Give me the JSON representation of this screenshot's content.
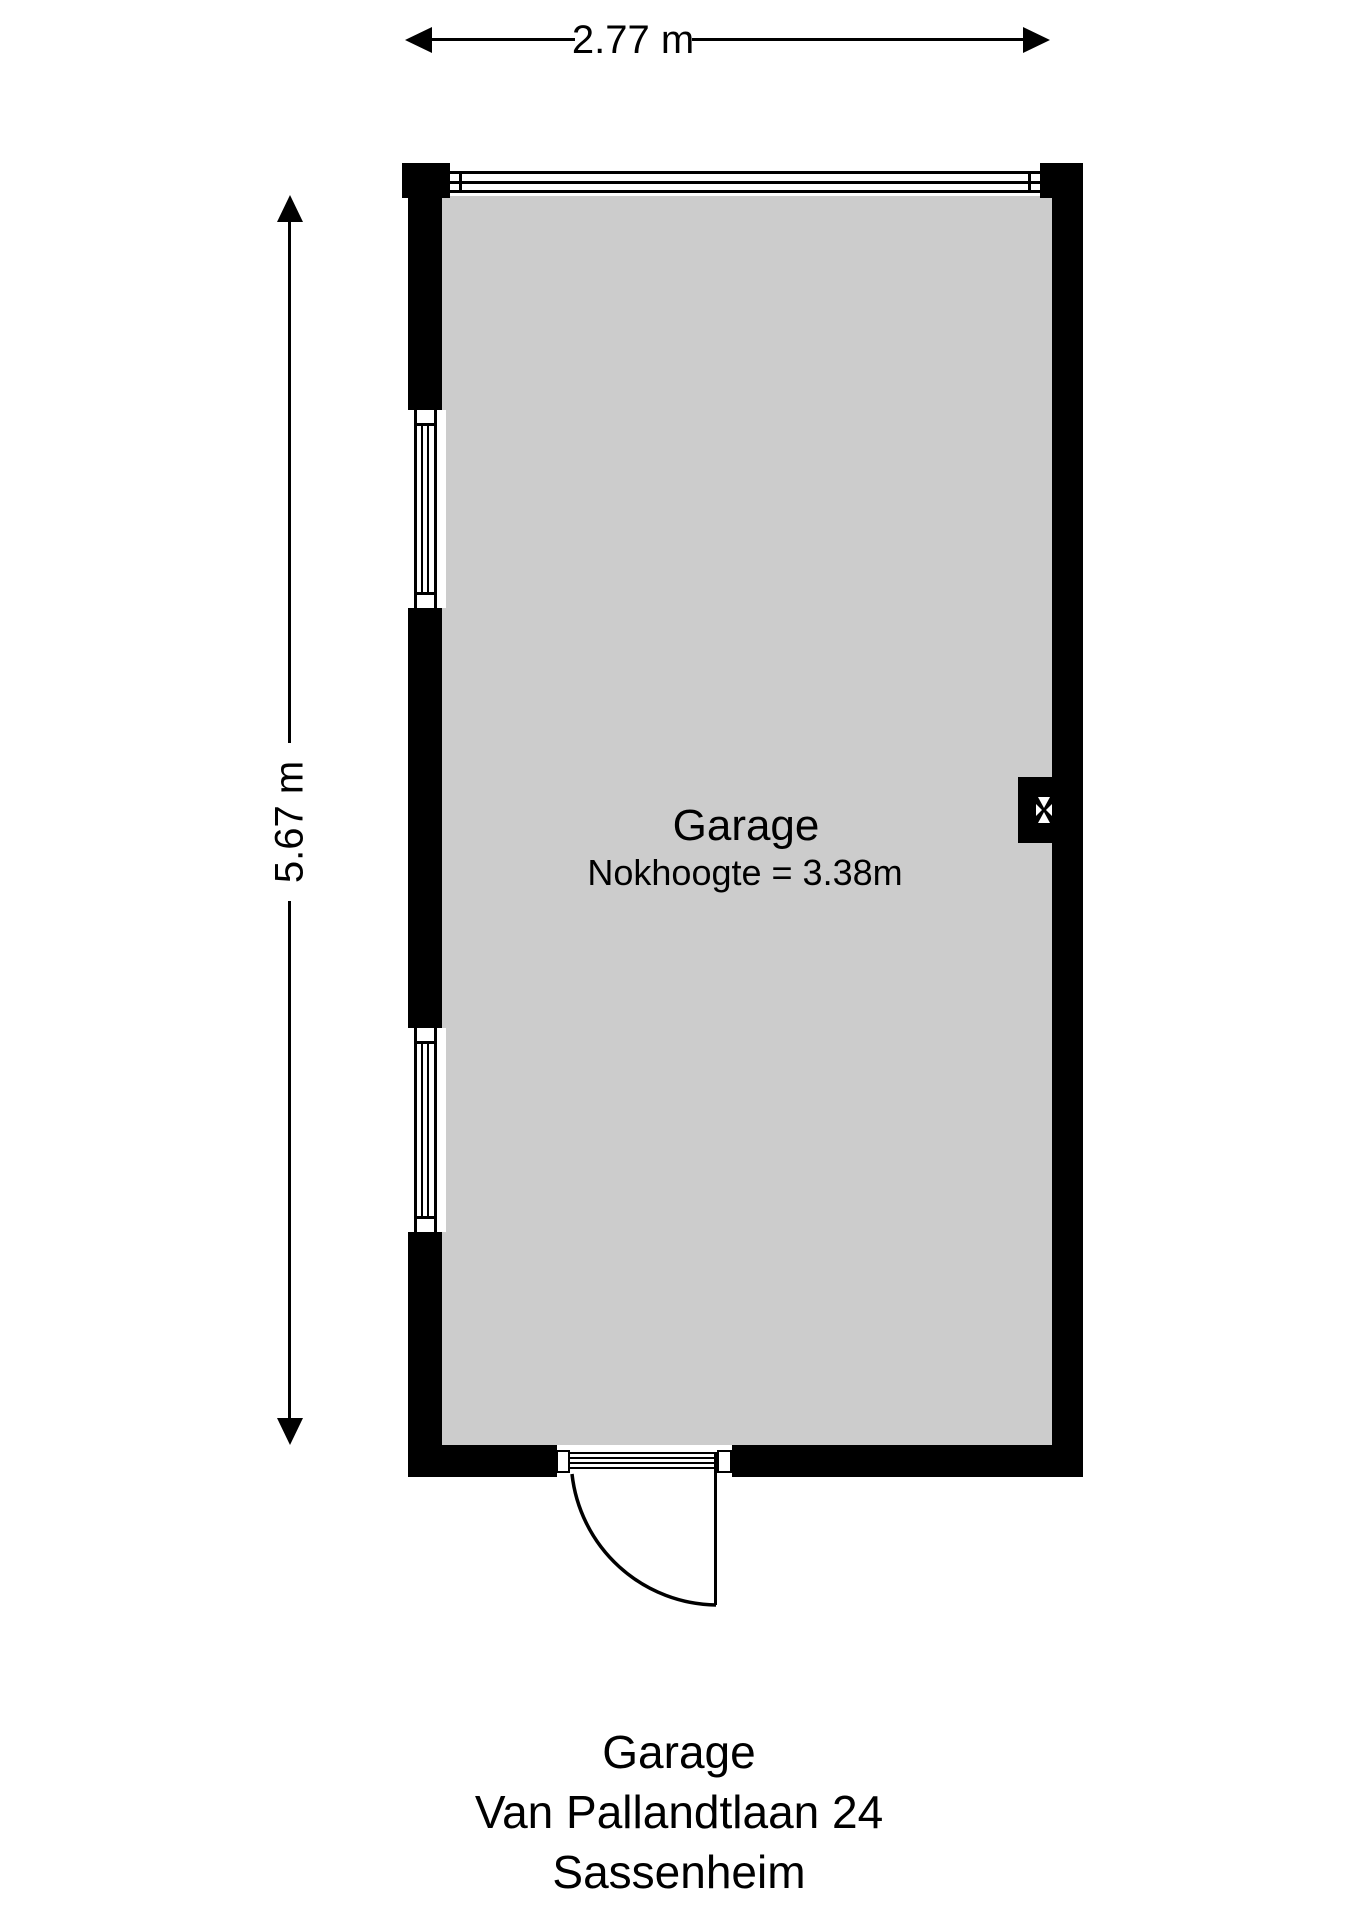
{
  "floorplan": {
    "room_label": "Garage",
    "room_sublabel": "Nokhoogte = 3.38m",
    "dim_width_label": "2.77 m",
    "dim_height_label": "5.67 m"
  },
  "caption": {
    "lines": [
      "Garage",
      "Van Pallandtlaan 24",
      "Sassenheim"
    ]
  },
  "icons": {
    "flue": "flue-vent-icon",
    "arrows": [
      "arrow-left-icon",
      "arrow-right-icon",
      "arrow-up-icon",
      "arrow-down-icon"
    ]
  },
  "colors": {
    "wall": "#000000",
    "floor_fill": "#cccccc",
    "background": "#ffffff",
    "text": "#000000"
  }
}
